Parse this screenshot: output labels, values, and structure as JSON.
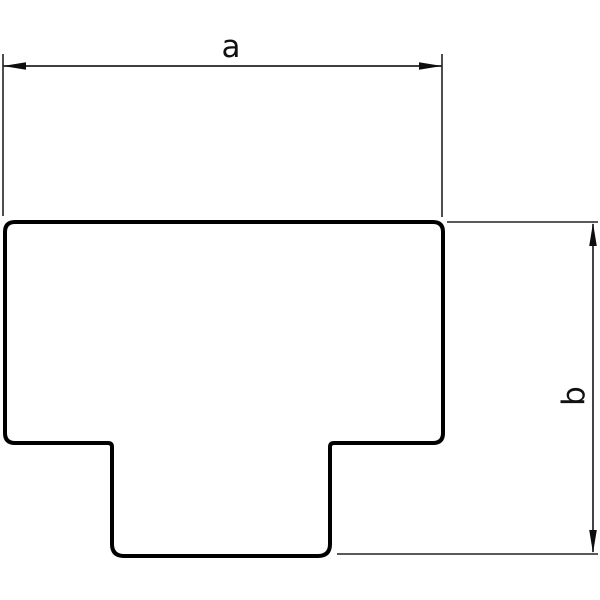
{
  "diagram": {
    "kind": "technical-dimension-drawing",
    "description": "Outline drawing of a T-shaped part (T-piece cover) with two dimension callouts",
    "labels": {
      "a": "a",
      "b": "b"
    },
    "colors": {
      "background": "#ffffff",
      "outline": "#000000",
      "thin_line": "#222222",
      "arrow": "#0d0d0d",
      "label": "#111111"
    }
  }
}
